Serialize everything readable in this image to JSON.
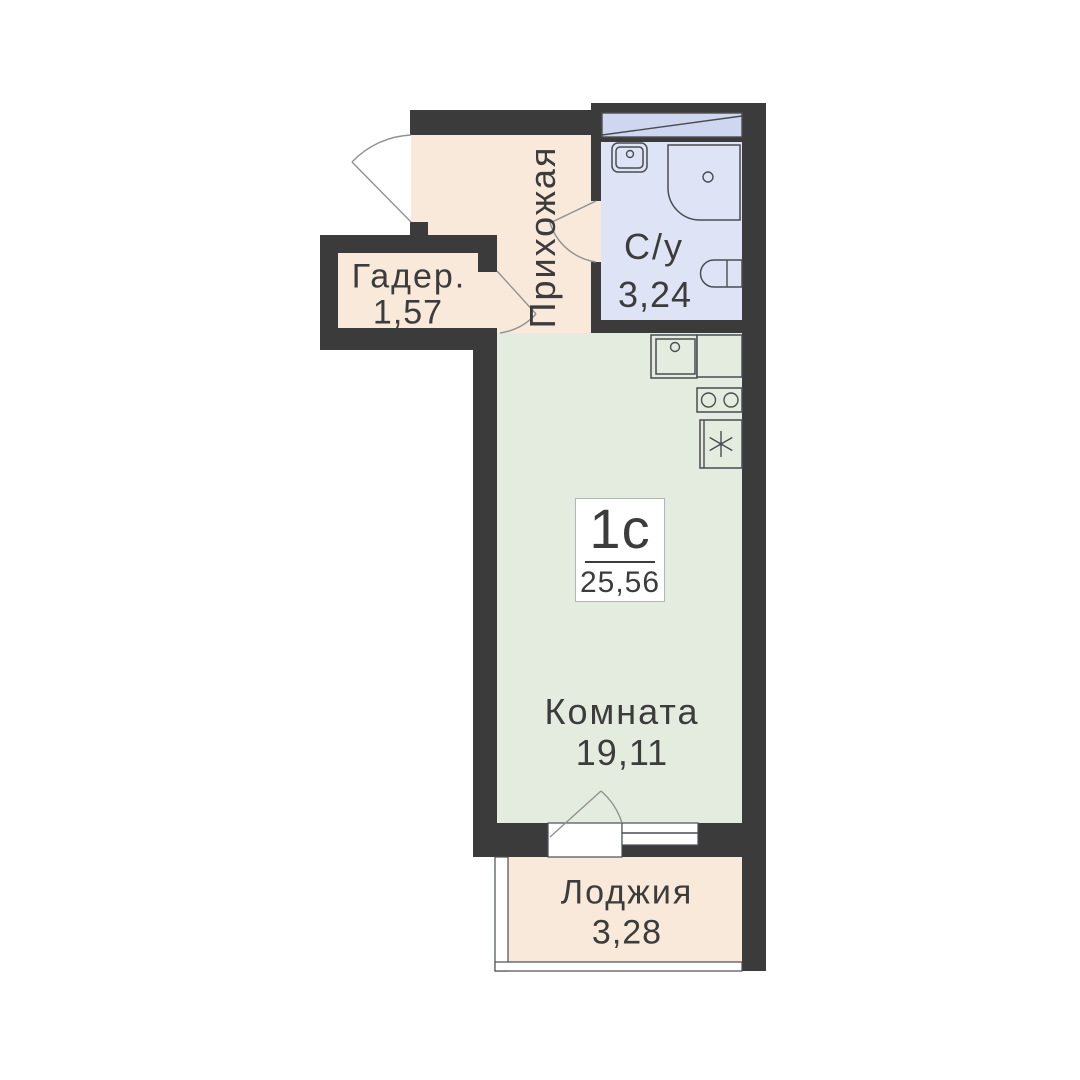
{
  "unit": {
    "type_label": "1с",
    "total_area": "25,56"
  },
  "rooms": {
    "wardrobe": {
      "name": "Гадер.",
      "area": "1,57"
    },
    "hallway": {
      "name": "Прихожая"
    },
    "bathroom": {
      "name": "С/у",
      "area": "3,24"
    },
    "living": {
      "name": "Комната",
      "area": "19,11"
    },
    "loggia": {
      "name": "Лоджия",
      "area": "3,28"
    }
  },
  "fixtures": [
    "entry-door",
    "bathroom-door",
    "wardrobe-door",
    "balcony-door",
    "window",
    "vent-shaft",
    "bath-sink",
    "shower",
    "toilet",
    "kitchen-sink",
    "kitchen-counter",
    "cooktop",
    "fridge",
    "loggia-glazing"
  ],
  "colors": {
    "wall": "#3b3b3c",
    "hall_fill": "#f8e9db",
    "bath_fill": "#dfe3f6",
    "vent_fill": "#ced6f0",
    "room_fill": "#e4ecdf",
    "loggia_fill": "#f8e9db",
    "line": "#4a4d52",
    "arc": "#919191",
    "text": "#3c3c3c",
    "box_border": "#b5b5b5"
  }
}
